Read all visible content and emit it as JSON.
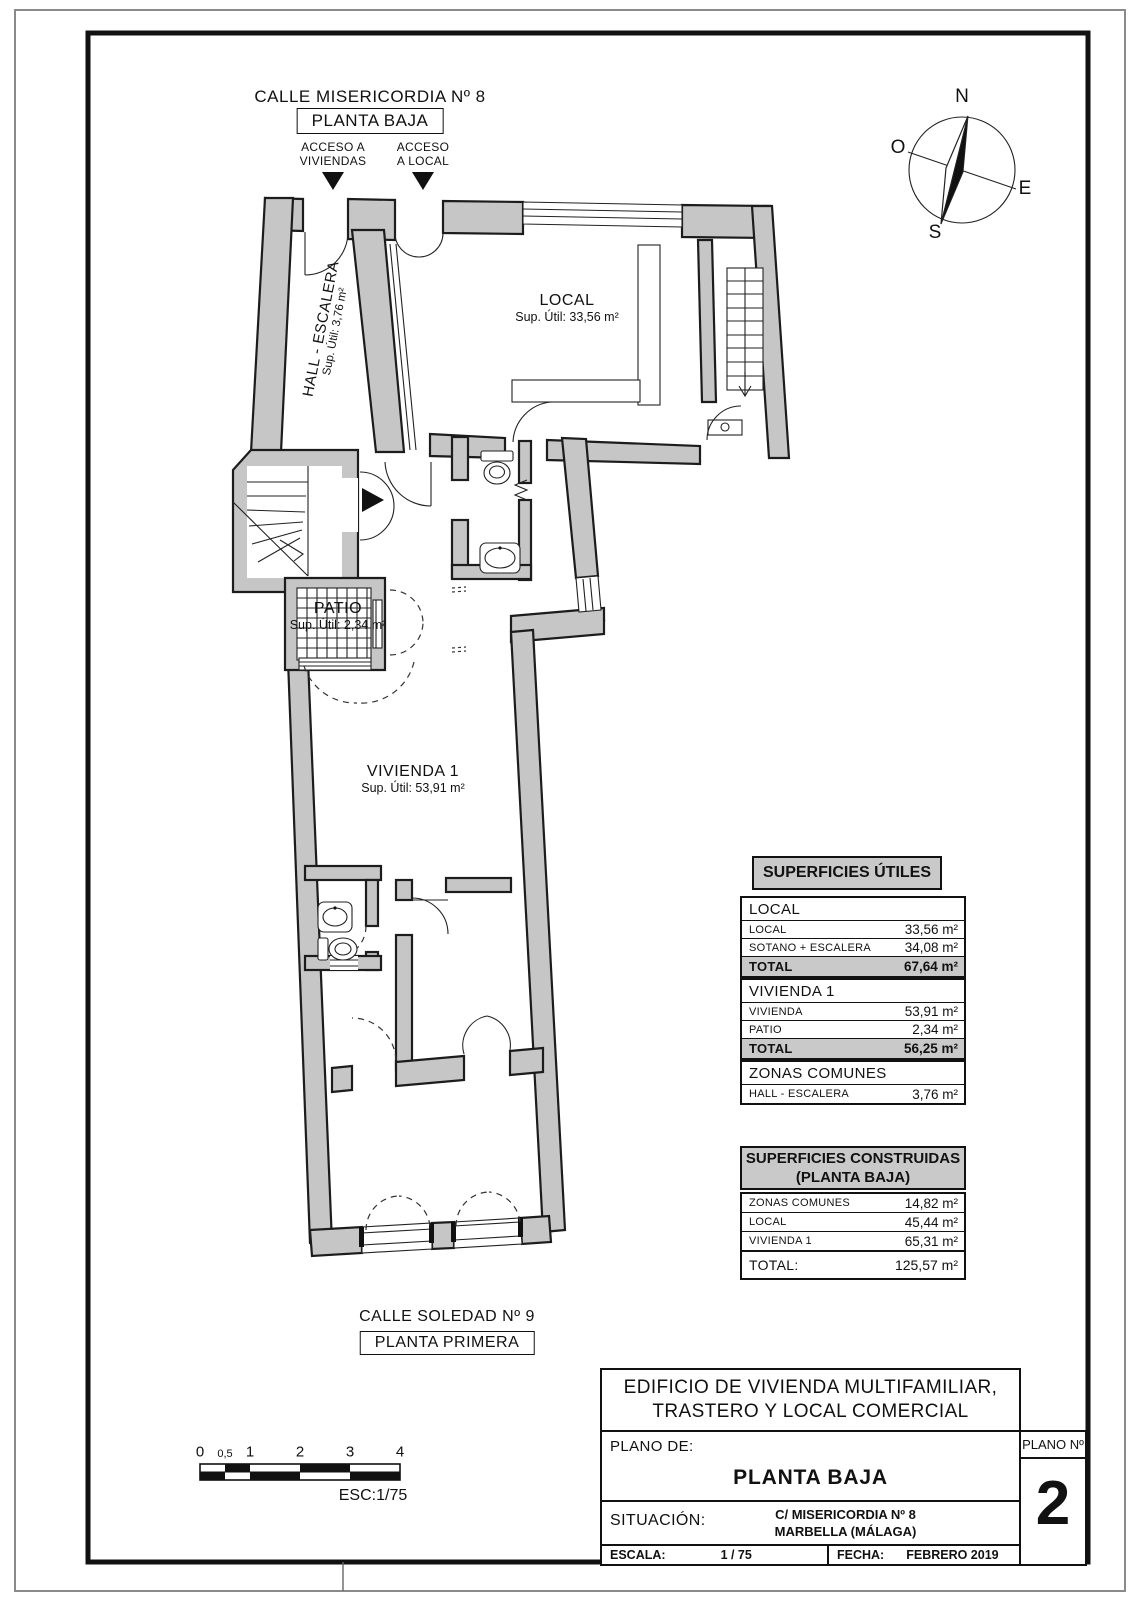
{
  "header": {
    "street": "CALLE MISERICORDIA Nº 8",
    "floor_box": "PLANTA BAJA",
    "access_left_line1": "ACCESO A",
    "access_left_line2": "VIVIENDAS",
    "access_right_line1": "ACCESO",
    "access_right_line2": "A LOCAL"
  },
  "compass": {
    "n": "N",
    "s": "S",
    "e": "E",
    "o": "O"
  },
  "plan_labels": {
    "hall": {
      "name": "HALL - ESCALERA",
      "area": "Sup. Útil: 3,76 m²"
    },
    "local": {
      "name": "LOCAL",
      "area": "Sup. Útil: 33,56 m²"
    },
    "patio": {
      "name": "PATIO",
      "area": "Sup. Útil: 2,34 m²"
    },
    "vivienda": {
      "name": "VIVIENDA 1",
      "area": "Sup. Útil: 53,91 m²"
    }
  },
  "tables": {
    "utiles": {
      "title": "SUPERFICIES ÚTILES",
      "sections": [
        {
          "header": "LOCAL",
          "rows": [
            {
              "label": "LOCAL",
              "value": "33,56 m²"
            },
            {
              "label": "SOTANO + ESCALERA",
              "value": "34,08 m²"
            }
          ],
          "total_label": "TOTAL",
          "total_value": "67,64 m²"
        },
        {
          "header": "VIVIENDA 1",
          "rows": [
            {
              "label": "VIVIENDA",
              "value": "53,91 m²"
            },
            {
              "label": "PATIO",
              "value": "2,34 m²"
            }
          ],
          "total_label": "TOTAL",
          "total_value": "56,25 m²"
        },
        {
          "header": "ZONAS COMUNES",
          "rows": [
            {
              "label": "HALL - ESCALERA",
              "value": "3,76 m²"
            }
          ]
        }
      ]
    },
    "construidas": {
      "title_line1": "SUPERFICIES CONSTRUIDAS",
      "title_line2": "(PLANTA BAJA)",
      "rows": [
        {
          "label": "ZONAS COMUNES",
          "value": "14,82 m²"
        },
        {
          "label": "LOCAL",
          "value": "45,44 m²"
        },
        {
          "label": "VIVIENDA 1",
          "value": "65,31 m²"
        }
      ],
      "total_label": "TOTAL:",
      "total_value": "125,57 m²"
    }
  },
  "footer": {
    "street": "CALLE SOLEDAD Nº 9",
    "floor_box": "PLANTA PRIMERA"
  },
  "scalebar": {
    "ticks": [
      "0",
      "0,5",
      "1",
      "2",
      "3",
      "4"
    ],
    "esc": "ESC:1/75"
  },
  "titleblock": {
    "project_line1": "EDIFICIO DE VIVIENDA MULTIFAMILIAR,",
    "project_line2": "TRASTERO Y LOCAL COMERCIAL",
    "plano_de_label": "PLANO DE:",
    "plano_de_value": "PLANTA BAJA",
    "situacion_label": "SITUACIÓN:",
    "situacion_line1": "C/ MISERICORDIA Nº 8",
    "situacion_line2": "MARBELLA (MÁLAGA)",
    "escala_label": "ESCALA:",
    "escala_value": "1 / 75",
    "fecha_label": "FECHA:",
    "fecha_value": "FEBRERO 2019",
    "plano_num_label": "PLANO Nº",
    "plano_num_value": "2"
  },
  "colors": {
    "wall": "#c6c6c6",
    "line": "#1a1a1a",
    "table_header_bg": "#c9c9c9"
  }
}
